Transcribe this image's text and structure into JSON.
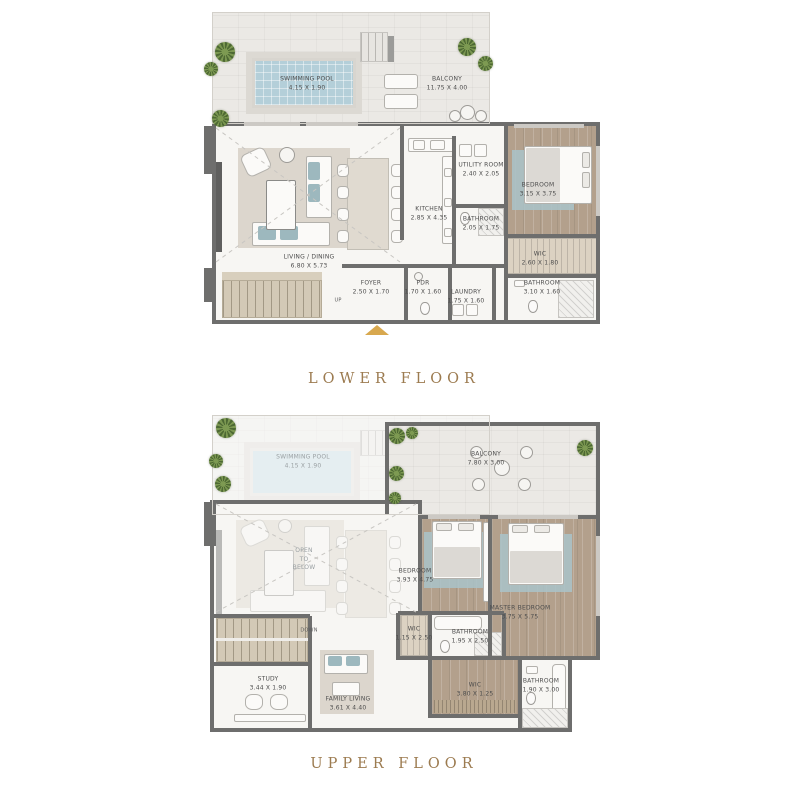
{
  "colors": {
    "walls": "#6e6e6d",
    "pool_water": "#b4cfd9",
    "wood_floor": "#b3a08c",
    "stone_terrace": "#ebe9e5",
    "title_text": "#9c7b50",
    "entrance_arrow": "#d8a84e",
    "plant_green": "#7b9751",
    "rug_blue": "#a9c3c9"
  },
  "titles": {
    "lower": "LOWER FLOOR",
    "upper": "UPPER FLOOR"
  },
  "lower": {
    "rooms": [
      {
        "name": "SWIMMING POOL",
        "dims": "4.15 X 1.90"
      },
      {
        "name": "BALCONY",
        "dims": "11.75 X 4.00"
      },
      {
        "name": "LIVING / DINING",
        "dims": "6.80 X 5.73"
      },
      {
        "name": "KITCHEN",
        "dims": "2.85 X 4.35"
      },
      {
        "name": "UTILITY ROOM",
        "dims": "2.40 X 2.05"
      },
      {
        "name": "BATHROOM",
        "dims": "2.05 X 1.75"
      },
      {
        "name": "BEDROOM",
        "dims": "3.15 X 3.75"
      },
      {
        "name": "WIC",
        "dims": "2.60 X 1.80"
      },
      {
        "name": "FOYER",
        "dims": "2.50 X 1.70"
      },
      {
        "name": "PDR",
        "dims": "1.70 X 1.60"
      },
      {
        "name": "LAUNDRY",
        "dims": "1.75 X 1.60"
      },
      {
        "name": "BATHROOM",
        "dims": "3.10 X 1.60"
      }
    ],
    "up_label": "UP"
  },
  "upper": {
    "rooms": [
      {
        "name": "SWIMMING POOL",
        "dims": "4.15 X 1.90"
      },
      {
        "name": "BALCONY",
        "dims": "7.80 X 3.00"
      },
      {
        "name": "BEDROOM",
        "dims": "3.93 X 4.75"
      },
      {
        "name": "MASTER BEDROOM",
        "dims": "3.75 X 5.75"
      },
      {
        "name": "WIC",
        "dims": "1.15 X 2.50"
      },
      {
        "name": "BATHROOM",
        "dims": "1.95 X 2.50"
      },
      {
        "name": "WIC",
        "dims": "3.80 X 1.25"
      },
      {
        "name": "BATHROOM",
        "dims": "1.90 X 3.00"
      },
      {
        "name": "STUDY",
        "dims": "3.44 X 1.90"
      },
      {
        "name": "FAMILY LIVING",
        "dims": "3.61 X 4.40"
      }
    ],
    "open_below": {
      "l1": "OPEN",
      "l2": "TO",
      "l3": "BELOW"
    },
    "down_label": "DOWN"
  }
}
